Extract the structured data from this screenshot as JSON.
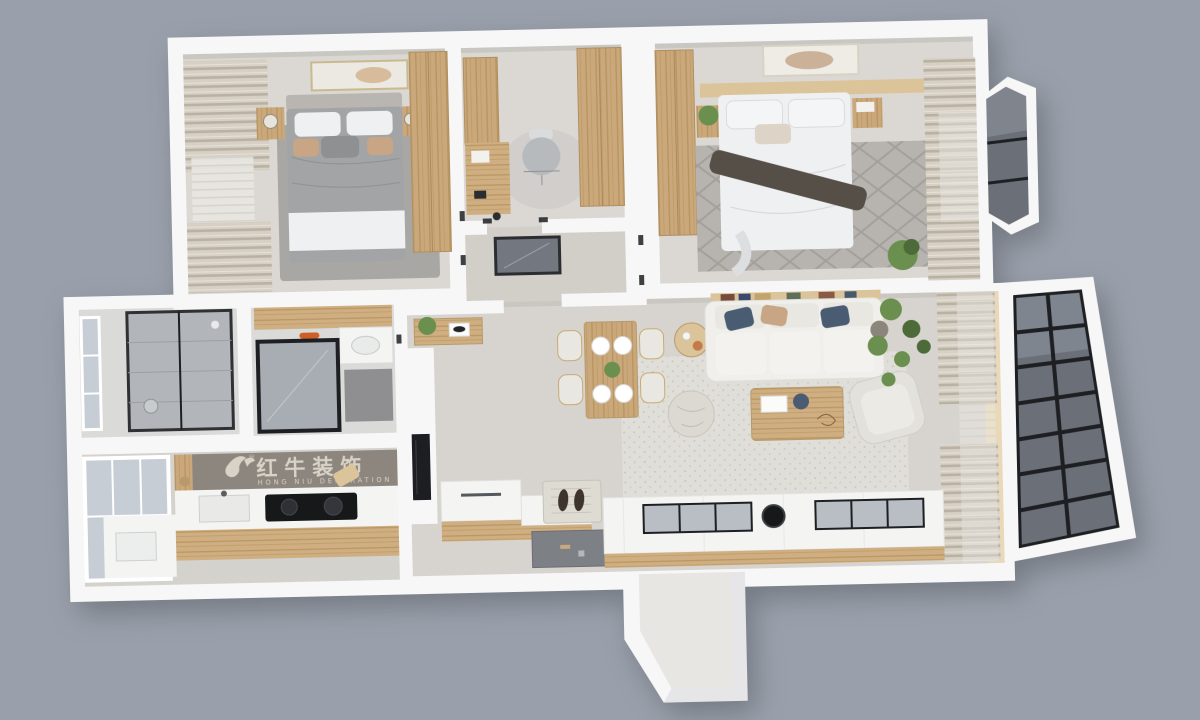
{
  "scene": {
    "description": "3D top-down rendering of a furnished apartment floor plan on a flat gray backdrop",
    "background_color": "#9aa0ab"
  },
  "watermark": {
    "zh": "红牛装饰",
    "en": "HONG NIU DECORATION",
    "registered": "®"
  },
  "rooms": [
    {
      "id": "bedroom-secondary",
      "features": [
        "double-bed-gray-duvet",
        "wardrobe",
        "curtained-window-wall",
        "nightstands-with-lamps",
        "gray-rug",
        "wall-art"
      ]
    },
    {
      "id": "study",
      "features": [
        "desk",
        "office-chair",
        "tall-cabinet",
        "wardrobe",
        "small-rug"
      ]
    },
    {
      "id": "entry-hall",
      "features": [
        "floor-mirror",
        "doorways"
      ]
    },
    {
      "id": "master-bedroom",
      "features": [
        "double-bed-white-duvet",
        "dark-throw",
        "wardrobe",
        "headboard-shelf",
        "diamond-pattern-rug",
        "curtain-wall",
        "plants",
        "bay-window",
        "wall-art"
      ]
    },
    {
      "id": "bathroom",
      "features": [
        "black-frame-glass-shower",
        "window"
      ]
    },
    {
      "id": "washroom",
      "features": [
        "wood-shelf",
        "white-vanity",
        "black-frame-mirror",
        "gray-mat",
        "orange-dish"
      ]
    },
    {
      "id": "kitchen",
      "features": [
        "gray-backsplash-with-brand-watermark",
        "white-counter",
        "black-cooktop",
        "sink",
        "window",
        "wood-base-cabinets"
      ]
    },
    {
      "id": "living-dining",
      "features": [
        "white-sofa-navy-tan-pillows",
        "book-shelf-behind-sofa",
        "wood-coffee-table",
        "pouf",
        "armchair",
        "tall-plant",
        "textured-rug",
        "dining-table-four-place-settings",
        "round-side-table",
        "console-table-with-plant",
        "tv-media-wall",
        "shoe-bench",
        "entry-mat-with-slippers",
        "recessed-entry-floor",
        "glass-top-display-cabinet",
        "sheer-curtains"
      ]
    },
    {
      "id": "balcony",
      "features": [
        "floor-to-ceiling-black-frame-glazing"
      ]
    },
    {
      "id": "entry-vestibule",
      "features": [
        "recessed-exterior-niche"
      ]
    }
  ],
  "palette": {
    "bg": "#9aa0ab",
    "wall": "#f7f7f8",
    "wallShade": "#e6e6e9",
    "floorMain": "#d7d4cf",
    "floorBedroom": "#dbd8d3",
    "floorHall": "#d2cfc9",
    "floorBath": "#dadad8",
    "floorKitchen": "#d4d2cd",
    "wood": "#c9a87c",
    "woodLight": "#dcc49a",
    "woodPale": "#ead9b8",
    "rugBedroom": "#a9a7a4",
    "rugMaster": "#b7b4b0",
    "rugLiving": "#e0ded8",
    "duvetGray": "#a3a4a6",
    "linen": "#eef0f1",
    "sofa": "#f0efeb",
    "pillowNavy": "#4a5c72",
    "pillowTan": "#c8a584",
    "glassDark": "#6b7078",
    "glassLight": "#c6cdd4",
    "frameDark": "#1d1f22",
    "curtain": "#d6d0c5",
    "curtainShade": "#b9b1a2",
    "sheer": "#e8e6e1",
    "green": "#6a8f4e",
    "greenDark": "#4c6b38",
    "counter": "#f4f4f2",
    "backsplash": "#8d867f",
    "watermark": "#d9d2c6",
    "cooktop": "#17181a",
    "mat": "#8f8f91",
    "accentOrange": "#cc5f28",
    "throwDark": "#564f47"
  }
}
